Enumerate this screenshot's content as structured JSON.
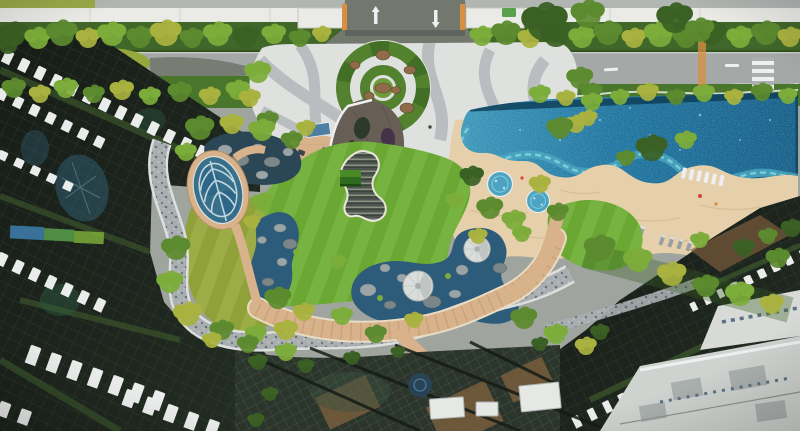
{
  "scene": {
    "type": "aerial-drone-photograph",
    "subject": "Condominium landscape deck: lagoon swimming pool, lawns, ponds and garden plaza surrounded by high-rise towers",
    "features": {
      "sun_loungers": 11,
      "in_pool_loungers": 6,
      "spa_pools": 2,
      "shade_domes": 2,
      "planting_circles": 1,
      "leaf_mosaic_ponds": 1
    }
  },
  "palette": {
    "top_gray": "#b2b6b3",
    "wall_white": "#eaebe7",
    "wall_edge": "#c9c6b8",
    "road_gray": "#a4a8a6",
    "asphalt": "#73786f",
    "plaza_light": "#dfe1de",
    "plaza_gray": "#b5babc",
    "paving_white": "#edeff0",
    "hedge_green": "#406629",
    "verge_green": "#4a762c",
    "tree_dark": "#3a6024",
    "tree_mid": "#5c8a2f",
    "tree_light": "#7cac39",
    "tree_yellow": "#a9b23f",
    "lawn_main": "#6fae35",
    "lawn_shade": "#5f9c2e",
    "lawn_left": "#96a83c",
    "steps_dark": "#4e5450",
    "steps_light": "#8c9289",
    "steps_deep": "#3c423e",
    "wood_deck": "#d7b28b",
    "wood_line": "#b98e63",
    "wood_brown": "#7a5c3c",
    "deck_edge": "#e8dcc4",
    "sand": "#e5d0ab",
    "sand_line": "#d2b88f",
    "pebble": "#a9aeb1",
    "pebble_dot": "#6d7376",
    "pebble_edge": "#dcdfdd",
    "pool_deep": "#145e88",
    "pool_mid": "#1d74a0",
    "pool_light": "#3b97ba",
    "pool_rim": "#0c3c55",
    "pool_pale": "#bfe2ea",
    "wave_teal": "#49a6bf",
    "wave_foam": "#7fd0da",
    "spa_water": "#4ea2c2",
    "pond_blue": "#2d5b7a",
    "pond_dark": "#2b4654",
    "rock_light": "#9aa4a7",
    "rock_dark": "#7b8689",
    "dome_white": "#d9dddb",
    "dome_shade": "#a8aeac",
    "bldg_dark": "#1c241d",
    "bldg_grid": "#46523f",
    "glass_green": "#3f5c2d",
    "glass_blue": "#38708c",
    "slat_white": "#f3f5f4",
    "trellis_base": "#2b352c",
    "trellis_grid": "#5b6d55",
    "dark_frame": "#141b15",
    "white_bldg": "#cfd3cf",
    "white_slab": "#d7dad6",
    "white_box": "#e6e8e6",
    "gray_panel": "#aab0ae",
    "window_blue": "#5b7286",
    "roof_pavilion": "#675f56",
    "roof_hole": "#2d3a2b",
    "roof_plum": "#44324a",
    "cube_green": "#2f6b1f",
    "cube_top": "#4a8a28",
    "panel_blue": "#4c7fa2",
    "disc_blue": "#28455a",
    "chair_gray": "#9aa0a2",
    "fig_dark": "#3d4547",
    "accent_red": "#d9453a",
    "accent_orange": "#d98f3f",
    "mural_blue": "#3f7fae",
    "mural_green": "#58a04a"
  }
}
